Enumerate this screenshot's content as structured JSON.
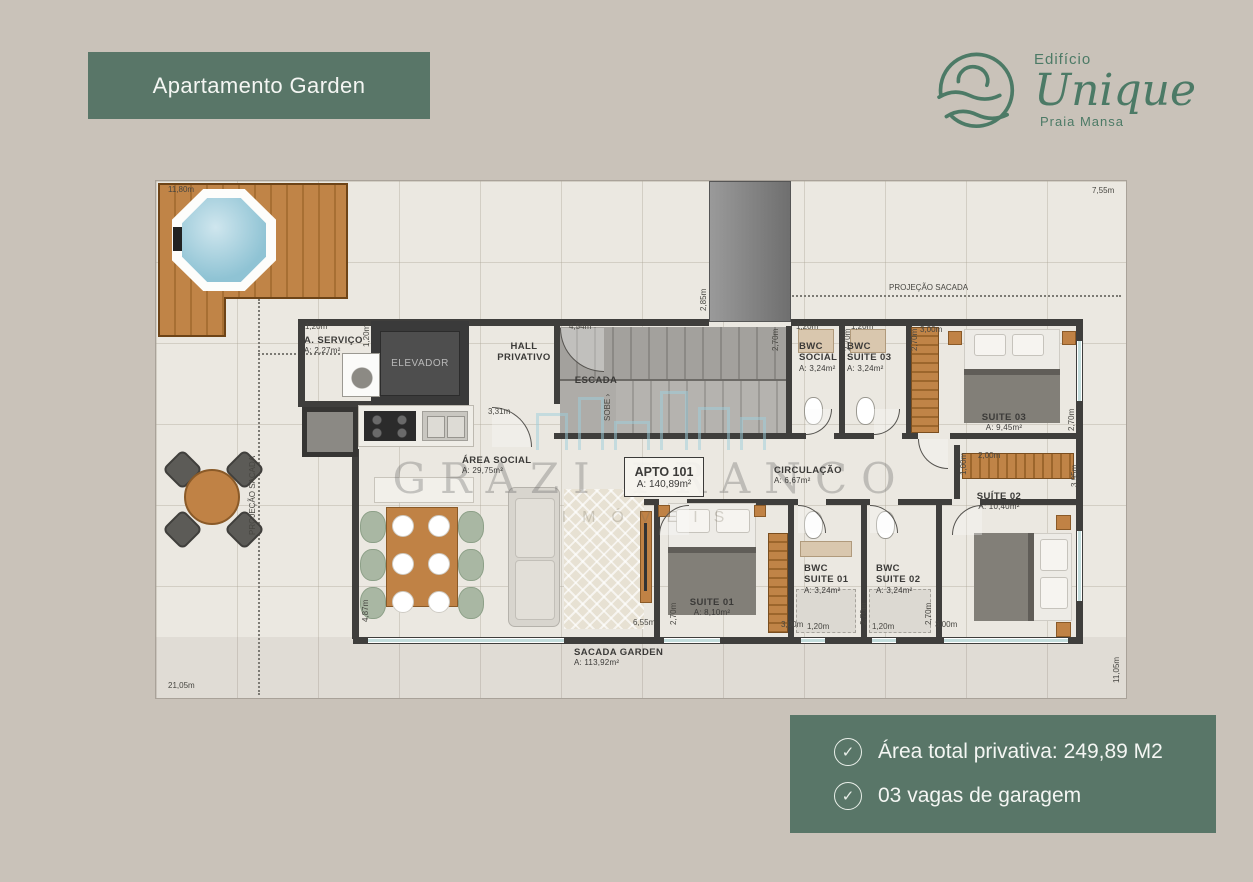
{
  "page": {
    "background": "#c9c2b9",
    "accent_green": "#597668",
    "logo_green": "#4c7a66"
  },
  "header": {
    "title": "Apartamento Garden"
  },
  "logo": {
    "building": "Edifício",
    "name": "Unique",
    "location": "Praia Mansa"
  },
  "info_box": {
    "items": [
      {
        "icon": "check-circle",
        "text": "Área total privativa: 249,89 M2"
      },
      {
        "icon": "check-circle",
        "text": "03 vagas de garagem"
      }
    ]
  },
  "floorplan": {
    "watermark": {
      "line1": "GRAZI FRANCO",
      "line2": "IMÓVEIS"
    },
    "unit_badge": {
      "name": "APTO 101",
      "area": "A: 140,89m²"
    },
    "elevator_label": "ELEVADOR",
    "rooms": [
      {
        "name": "A. SERVIÇO",
        "area": "A: 2,27m²",
        "x": 148,
        "y": 154
      },
      {
        "name": "HALL",
        "name2": "PRIVATIVO",
        "x": 368,
        "y": 160,
        "ctr": true
      },
      {
        "name": "ESCADA",
        "x": 440,
        "y": 194,
        "ctr": true
      },
      {
        "name": "BWC",
        "name2": "SOCIAL",
        "area": "A: 3,24m²",
        "x": 643,
        "y": 160
      },
      {
        "name": "BWC",
        "name2": "SUITE 03",
        "area": "A: 3,24m²",
        "x": 691,
        "y": 160
      },
      {
        "name": "SUITE 03",
        "area": "A: 9,45m²",
        "x": 848,
        "y": 231,
        "ctr": true
      },
      {
        "name": "ÁREA SOCIAL",
        "area": "A: 29,75m²",
        "x": 306,
        "y": 274
      },
      {
        "name": "CIRCULAÇÃO",
        "area": "A: 6,67m²",
        "x": 618,
        "y": 284
      },
      {
        "name": "SUITE 01",
        "area": "A: 8,10m²",
        "x": 556,
        "y": 416,
        "ctr": true
      },
      {
        "name": "BWC",
        "name2": "SUITE 01",
        "area": "A: 3,24m²",
        "x": 648,
        "y": 382
      },
      {
        "name": "BWC",
        "name2": "SUITE 02",
        "area": "A: 3,24m²",
        "x": 720,
        "y": 382
      },
      {
        "name": "SUÍTE 02",
        "area": "A: 10,40m²",
        "x": 843,
        "y": 310,
        "ctr": true
      },
      {
        "name": "SACADA GARDEN",
        "area": "A: 113,92m²",
        "x": 418,
        "y": 466
      }
    ],
    "dimensions": [
      {
        "text": "11,80m",
        "x": 12,
        "y": 4
      },
      {
        "text": "7,55m",
        "x": 936,
        "y": 5
      },
      {
        "text": "PROJEÇÃO SACADA",
        "x": 733,
        "y": 102
      },
      {
        "text": "2,85m",
        "x": 543,
        "y": 130,
        "rot": true
      },
      {
        "text": "4,54m",
        "x": 413,
        "y": 141
      },
      {
        "text": "1,20m",
        "x": 149,
        "y": 141
      },
      {
        "text": "1,20m",
        "x": 206,
        "y": 166,
        "rot": true
      },
      {
        "text": "2,70m",
        "x": 615,
        "y": 170,
        "rot": true
      },
      {
        "text": "1,20m",
        "x": 640,
        "y": 141
      },
      {
        "text": "2,70m",
        "x": 687,
        "y": 170,
        "rot": true
      },
      {
        "text": "1,20m",
        "x": 695,
        "y": 141
      },
      {
        "text": "2,70m",
        "x": 754,
        "y": 170,
        "rot": true
      },
      {
        "text": "3,00m",
        "x": 764,
        "y": 144
      },
      {
        "text": "2,70m",
        "x": 911,
        "y": 250,
        "rot": true
      },
      {
        "text": "1,00m",
        "x": 803,
        "y": 294,
        "rot": true
      },
      {
        "text": "2,00m",
        "x": 822,
        "y": 270
      },
      {
        "text": "3,95m",
        "x": 914,
        "y": 306,
        "rot": true
      },
      {
        "text": "3,31m",
        "x": 332,
        "y": 226
      },
      {
        "text": "SOBE ›",
        "x": 447,
        "y": 240,
        "rot": true
      },
      {
        "text": "PROJEÇÃO SACADA",
        "x": 92,
        "y": 354,
        "rot": true
      },
      {
        "text": "4,87m",
        "x": 205,
        "y": 441,
        "rot": true
      },
      {
        "text": "6,55m",
        "x": 477,
        "y": 437
      },
      {
        "text": "2,70m",
        "x": 513,
        "y": 444,
        "rot": true
      },
      {
        "text": "3,00m",
        "x": 625,
        "y": 439
      },
      {
        "text": "1,20m",
        "x": 651,
        "y": 441
      },
      {
        "text": "2,70m",
        "x": 703,
        "y": 444,
        "rot": true
      },
      {
        "text": "1,20m",
        "x": 716,
        "y": 441
      },
      {
        "text": "2,70m",
        "x": 768,
        "y": 444,
        "rot": true
      },
      {
        "text": "3,00m",
        "x": 779,
        "y": 439
      },
      {
        "text": "21,05m",
        "x": 12,
        "y": 500
      },
      {
        "text": "11,05m",
        "x": 956,
        "y": 502,
        "rot": true
      }
    ]
  }
}
